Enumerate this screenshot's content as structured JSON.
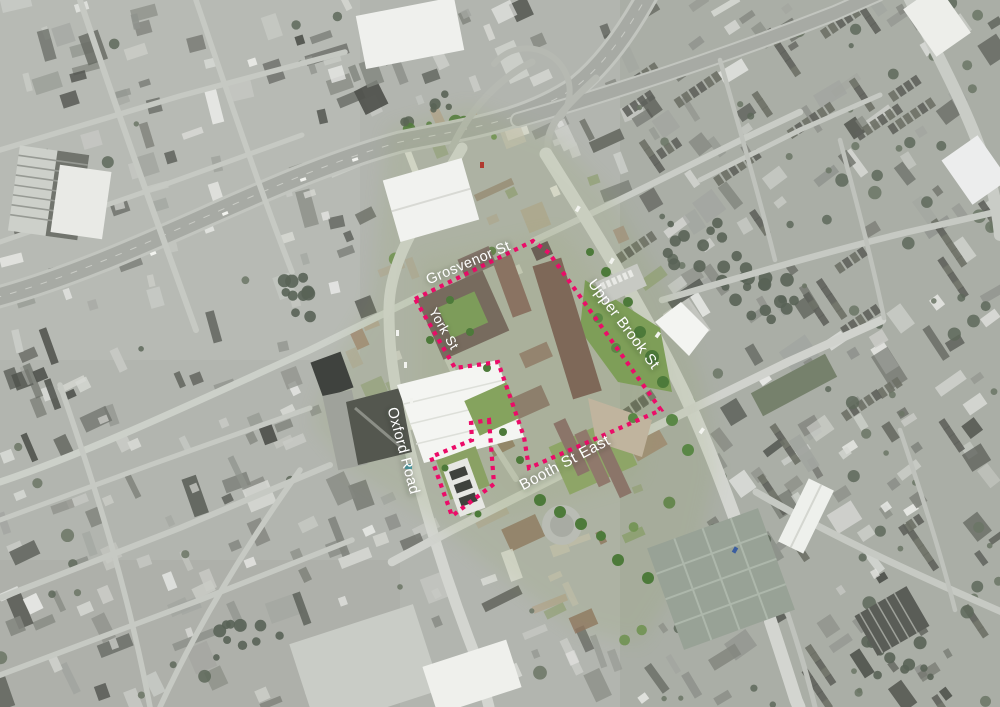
{
  "map": {
    "description": "Greyscale aerial photograph of a city centre; the university development site along Oxford Road is shown in colour and outlined with a pink dashed site boundary",
    "boundary_color": "#eb0c68",
    "label_color": "#ffffff"
  },
  "street_labels": [
    {
      "id": "grosvenor",
      "text": "Grosvenor St",
      "x": 470,
      "y": 267,
      "rotation": -23,
      "size": 14.5
    },
    {
      "id": "york",
      "text": "York St",
      "x": 440,
      "y": 331,
      "rotation": 60,
      "size": 13.5
    },
    {
      "id": "oxford",
      "text": "Oxford Road",
      "x": 399,
      "y": 452,
      "rotation": 75,
      "size": 15
    },
    {
      "id": "upper-brook",
      "text": "Upper Brook St",
      "x": 620,
      "y": 327,
      "rotation": 53,
      "size": 15
    },
    {
      "id": "booth",
      "text": "Booth St East",
      "x": 567,
      "y": 467,
      "rotation": -28,
      "size": 15.5
    }
  ],
  "site_boundary": {
    "color": "#eb0c68",
    "style": "dashed",
    "stroke_width": 4.2,
    "dash": [
      4.2,
      5
    ],
    "paths": [
      {
        "name": "main-site",
        "closed": true,
        "points": [
          [
            415,
            299
          ],
          [
            533,
            241
          ],
          [
            549,
            253
          ],
          [
            661,
            410
          ],
          [
            529,
            468
          ],
          [
            524,
            437
          ],
          [
            498,
            362
          ],
          [
            455,
            368
          ]
        ]
      },
      {
        "name": "oxford-road-parcel",
        "closed": true,
        "points": [
          [
            489,
            420
          ],
          [
            494,
            484
          ],
          [
            452,
            516
          ],
          [
            431,
            457
          ],
          [
            472,
            440
          ],
          [
            471,
            423
          ]
        ]
      }
    ]
  }
}
